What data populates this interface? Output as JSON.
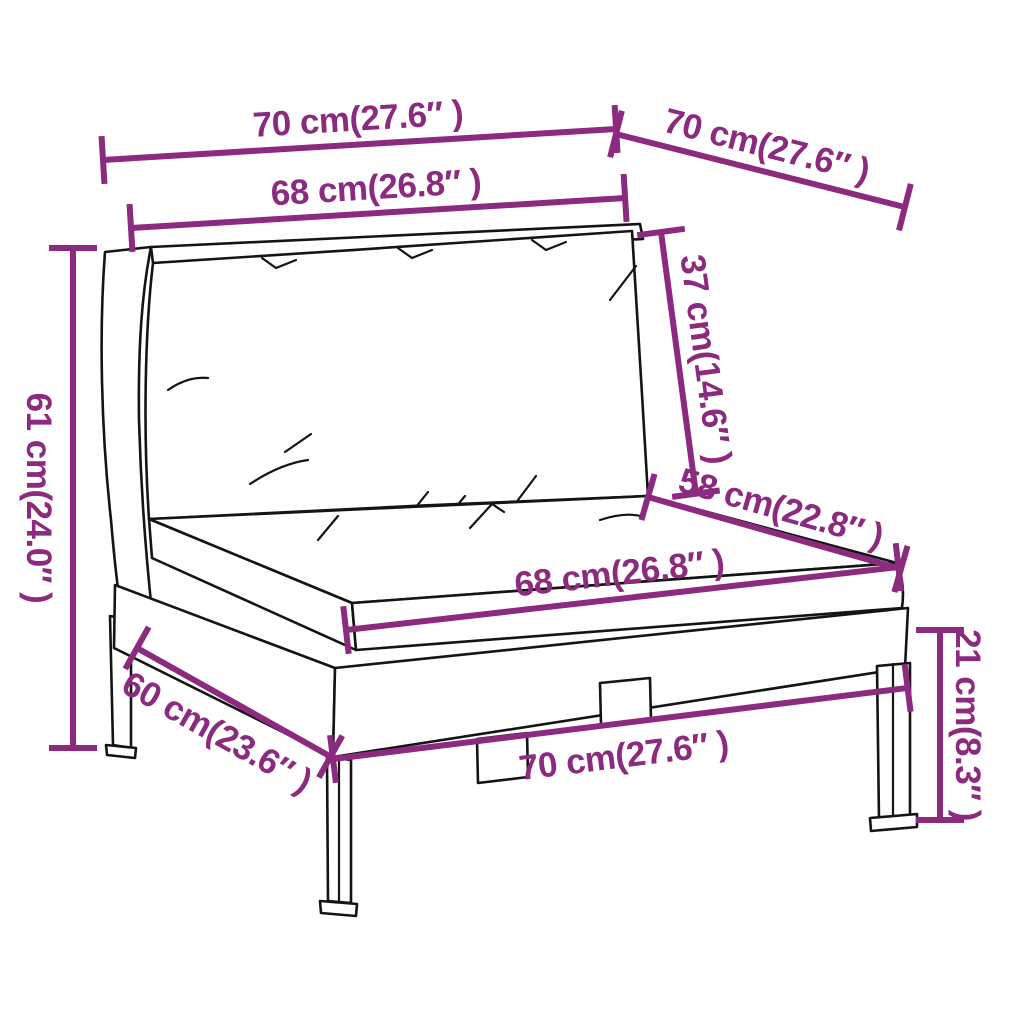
{
  "colors": {
    "accent": "#8b2a7f",
    "line": "#141414",
    "bg": "#ffffff"
  },
  "diagram": {
    "type": "product-dimension-diagram",
    "dimensions": {
      "top_width": {
        "cm": 70,
        "inches": 27.6,
        "label": "70 cm(27.6″ )"
      },
      "top_depth": {
        "cm": 70,
        "inches": 27.6,
        "label": "70 cm(27.6″ )"
      },
      "back_cushion_width": {
        "cm": 68,
        "inches": 26.8,
        "label": "68 cm(26.8″ )"
      },
      "back_cushion_height": {
        "cm": 37,
        "inches": 14.6,
        "label": "37 cm(14.6″ )"
      },
      "seat_cushion_depth": {
        "cm": 58,
        "inches": 22.8,
        "label": "58 cm(22.8″ )"
      },
      "overall_height": {
        "cm": 61,
        "inches": 24.0,
        "label": "61 cm(24.0″ )"
      },
      "seat_cushion_width": {
        "cm": 68,
        "inches": 26.8,
        "label": "68 cm(26.8″ )"
      },
      "leg_height": {
        "cm": 21,
        "inches": 8.3,
        "label": "21 cm(8.3″ )"
      },
      "base_width": {
        "cm": 70,
        "inches": 27.6,
        "label": "70 cm(27.6″ )"
      },
      "base_depth": {
        "cm": 60,
        "inches": 23.6,
        "label": "60 cm(23.6″ )"
      }
    }
  }
}
